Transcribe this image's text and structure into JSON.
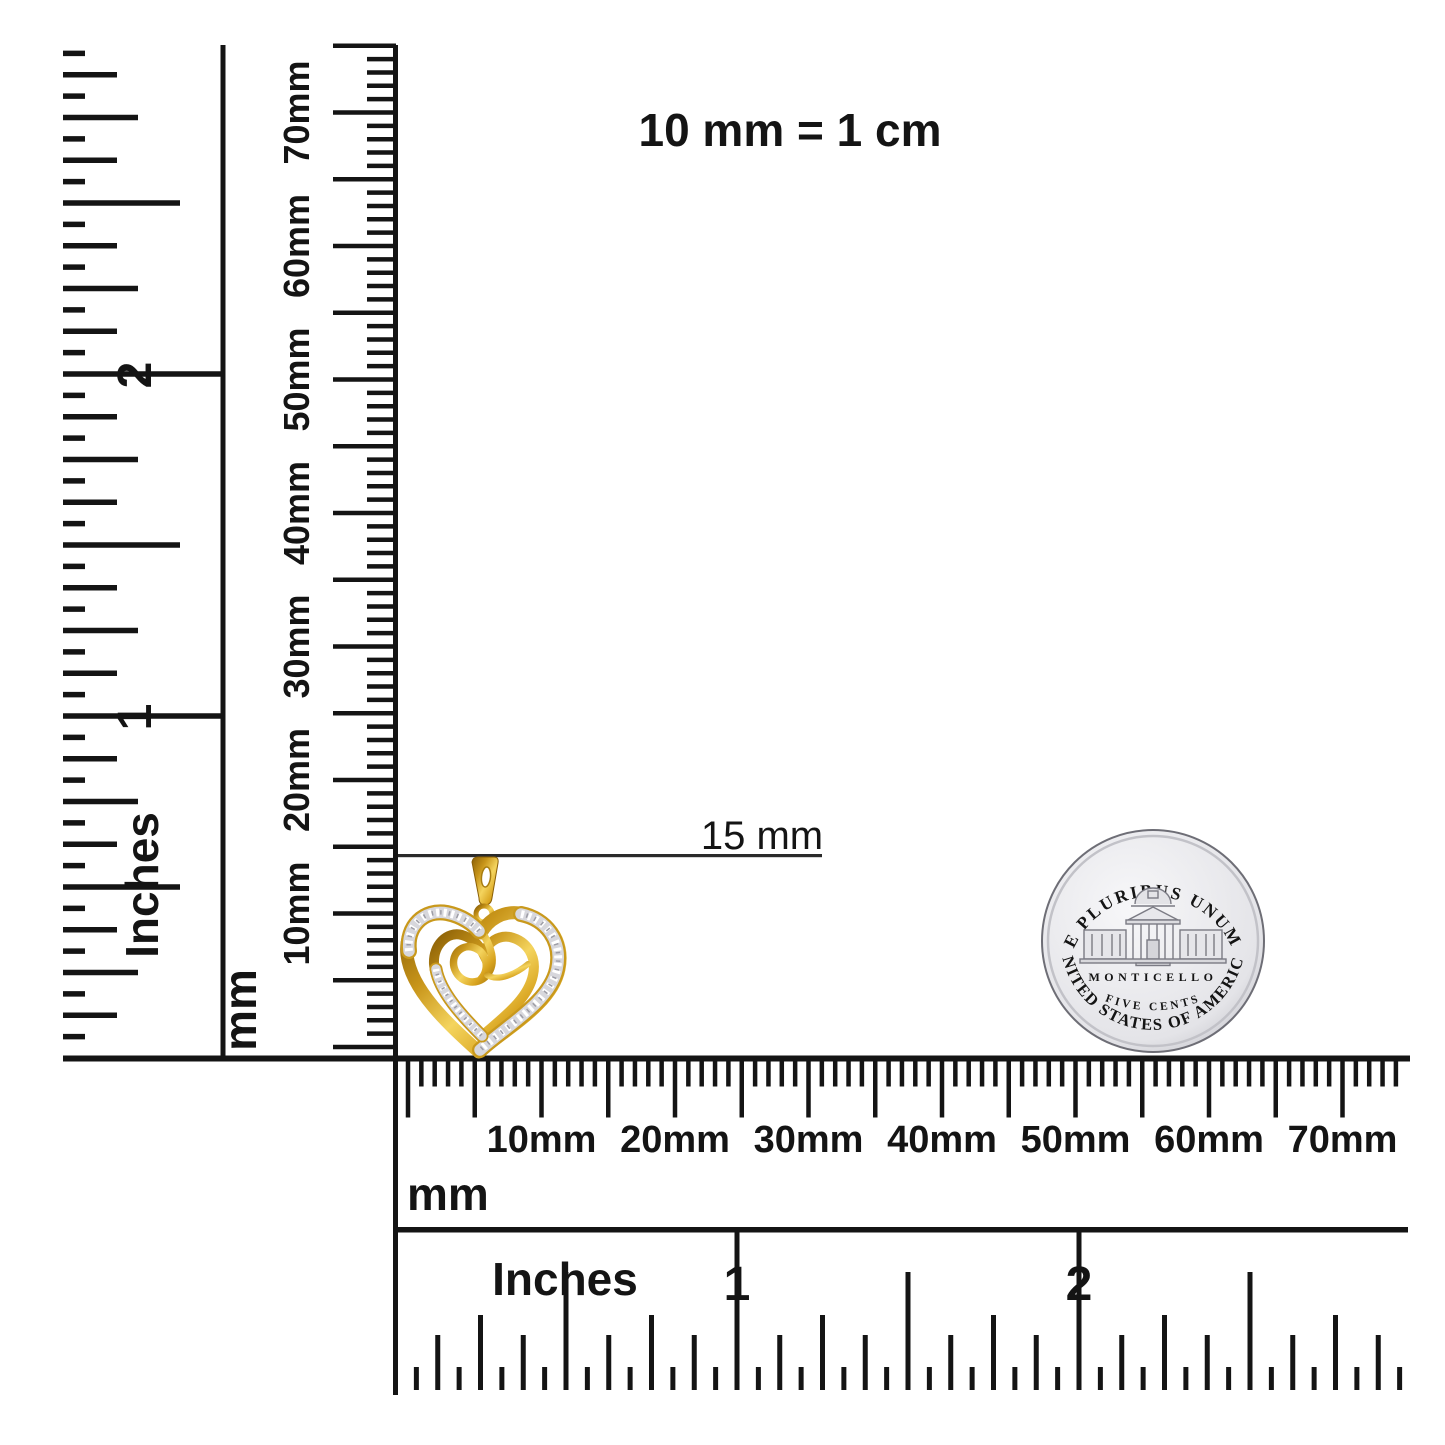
{
  "note": {
    "text": "10 mm = 1 cm"
  },
  "measurement": {
    "label": "15 mm"
  },
  "rulers": {
    "left_inches": {
      "unit": "Inches",
      "inch_numbers": [
        "1",
        "2"
      ]
    },
    "left_mm": {
      "unit": "mm",
      "tick_labels": [
        "10mm",
        "20mm",
        "30mm",
        "40mm",
        "50mm",
        "60mm",
        "70mm"
      ]
    },
    "bottom_mm": {
      "unit": "mm",
      "tick_labels": [
        "10mm",
        "20mm",
        "30mm",
        "40mm",
        "50mm",
        "60mm",
        "70mm"
      ]
    },
    "bottom_inches": {
      "unit": "Inches",
      "inch_numbers": [
        "1",
        "2"
      ]
    }
  },
  "coin": {
    "legend_top": "E PLURIBUS UNUM",
    "building_label": "MONTICELLO",
    "denomination": "FIVE CENTS",
    "legend_bottom": "UNITED STATES OF AMERICA"
  },
  "pendant": {
    "description": "yellow gold diamond swirl heart pendant"
  },
  "colors": {
    "ink": "#141414",
    "gold": "#d8a31e",
    "gold_dark": "#8a5f06",
    "gold_light": "#f4d45e",
    "pave": "#d7d7dc",
    "coin_face": "#ececef",
    "coin_detail": "#70707a"
  }
}
